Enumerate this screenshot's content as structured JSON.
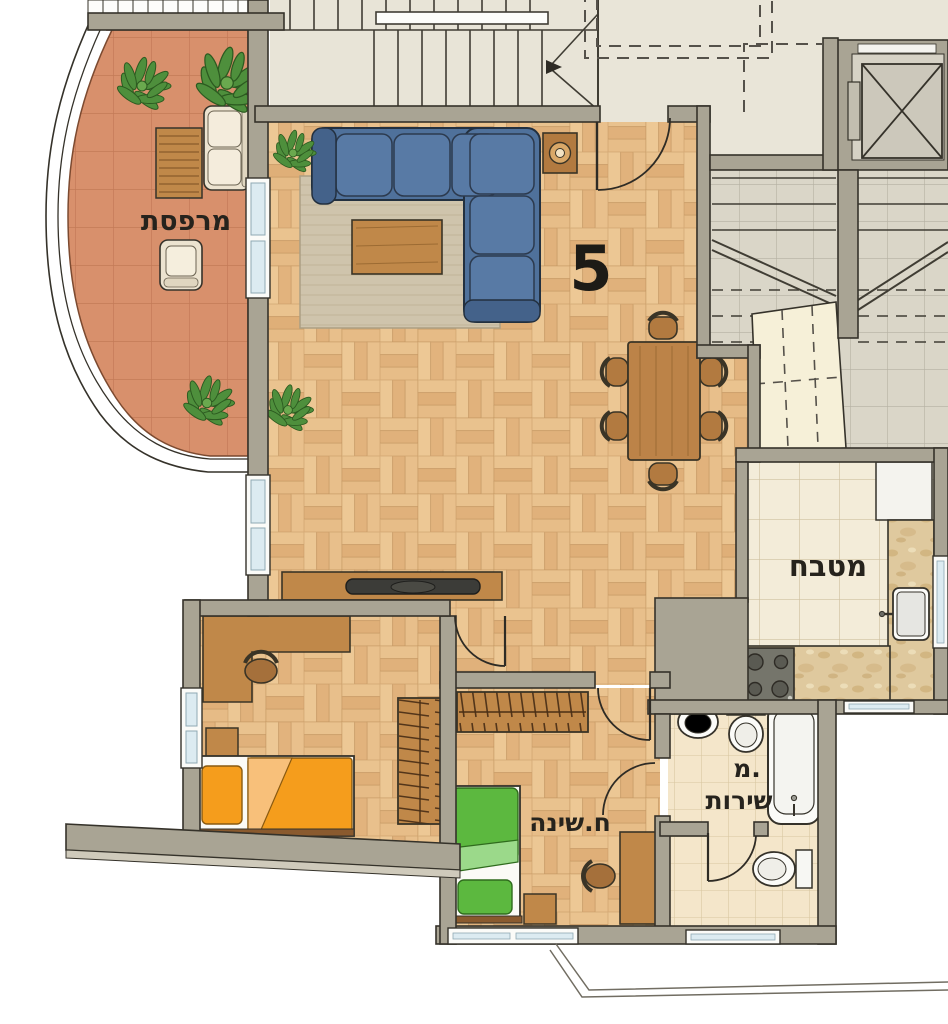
{
  "plan": {
    "unit_number": "5",
    "labels": {
      "balcony": "מרפסת",
      "kitchen": "מטבח",
      "bedroom": "ח.שינה",
      "bathroom_line1": "מ.",
      "bathroom_line2": "שירות"
    },
    "colors": {
      "wall": "#a9a494",
      "outline": "#35322a",
      "parquet": "#e4bb86",
      "terracotta": "#d8906c",
      "rug": "#cfc4ac",
      "sofa_blue": "#4f719b",
      "wood": "#c08849",
      "wood_dark": "#9c6b33",
      "orange_bed": "#f59d1c",
      "green_bed": "#5cb83f",
      "kitchen_tile": "#f3ecd9",
      "bath_tile": "#f4e6ca",
      "common_tile": "#dad6c8",
      "plaster": "#e9e5d8",
      "counter_marble": "#dfc99e",
      "window_glass": "#dcebf1",
      "label_color": "#26231d"
    }
  }
}
